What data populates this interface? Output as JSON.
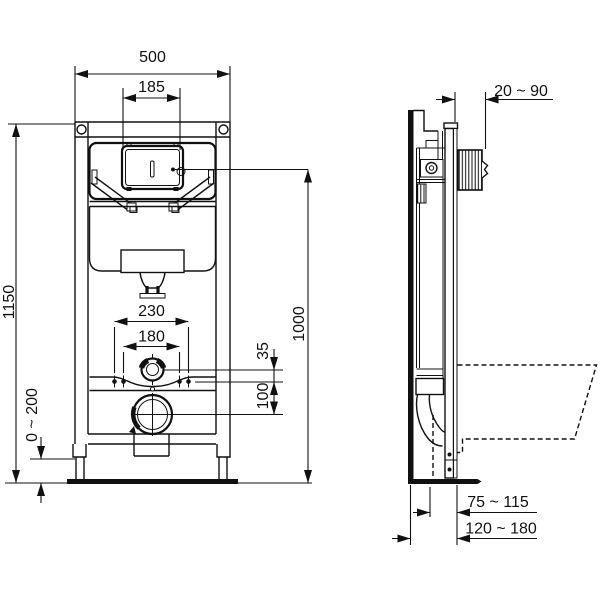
{
  "front_view": {
    "width_label": "500",
    "plate_width_label": "185",
    "height_label": "1150",
    "foot_adjust_label": "0 ~ 200",
    "fixing_outer_label": "230",
    "fixing_inner_label": "180",
    "offset_label": "35",
    "outlet_drop_label": "100",
    "actuator_height_label": "1000"
  },
  "side_view": {
    "wall_distance_label": "20 ~ 90",
    "outlet_near_label": "75 ~ 115",
    "outlet_far_label": "120 ~ 180"
  },
  "colors": {
    "line": "#111111",
    "background": "#ffffff"
  }
}
